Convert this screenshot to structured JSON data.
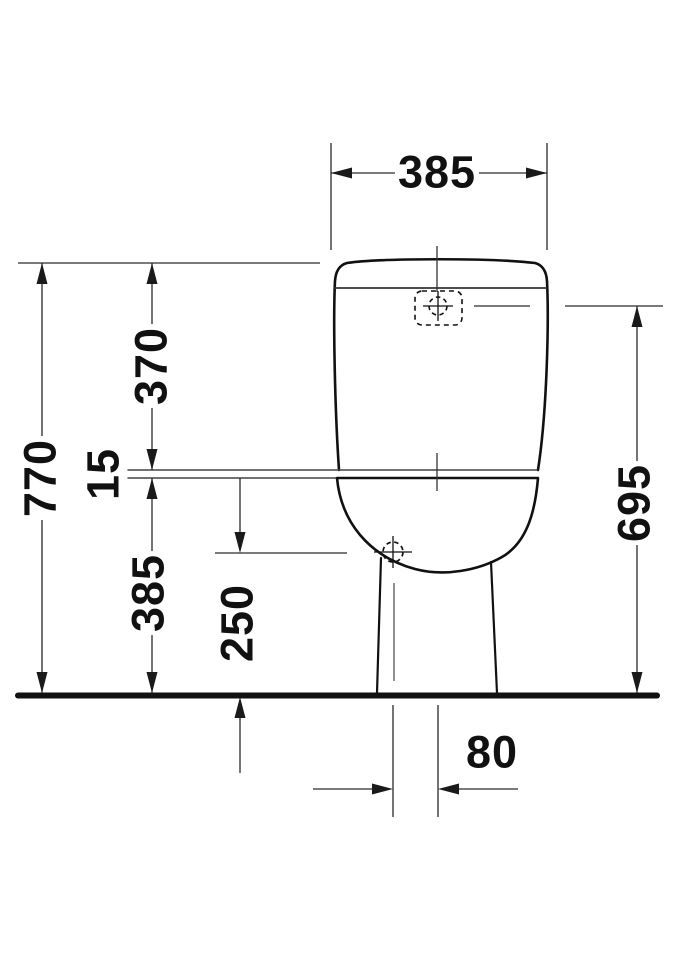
{
  "drawing": {
    "kind": "technical dimension drawing",
    "subject": "close-coupled toilet, front elevation",
    "units": "mm",
    "colors": {
      "outline": "#111111",
      "dimension_lines": "#2a2a2a",
      "thin_reference": "#555555",
      "background": "#ffffff"
    },
    "labels": {
      "width_overall": "385",
      "height_overall": "770",
      "cistern_height": "370",
      "joint_gap": "15",
      "bowl_height": "385",
      "button_level_height": "695",
      "outlet_height": "250",
      "outlet_offset": "80"
    }
  }
}
